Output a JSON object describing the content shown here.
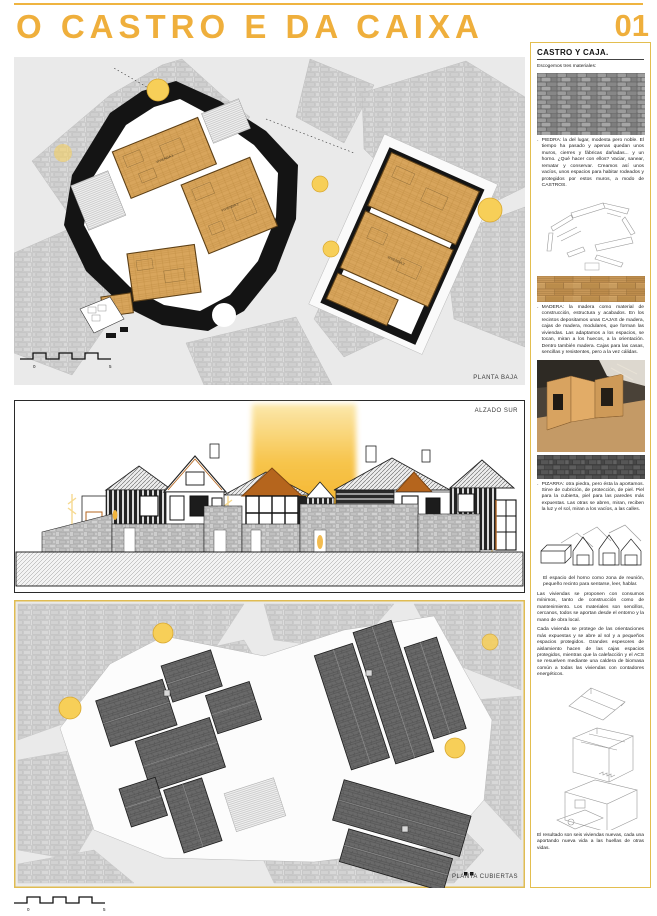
{
  "header": {
    "title": "O CASTRO E DA CAIXA",
    "page_number": "01"
  },
  "panels": {
    "planta_baja": {
      "label": "PLANTA BAJA",
      "scale_zero": "0",
      "scale_five": "5",
      "rooms": [
        "VIVIENDA 1",
        "VIVIENDA 2",
        "VIVIENDA 3"
      ]
    },
    "alzado_sur": {
      "label": "ALZADO SUR"
    },
    "planta_cubiertas": {
      "label": "PLANTA CUBIERTAS"
    },
    "page_scale": {
      "zero": "0",
      "five": "5"
    }
  },
  "sidebar": {
    "heading": "CASTRO Y CAJA.",
    "intro": "Escogemos tres materiales:",
    "bullet": "·",
    "piedra": "PIEDRA: la del lugar, modesta pero noble. El tiempo ha pasado y apenas quedan unos muros, cierres y fábricas dañadas... y un horno. ¿Qué hacer con ellos? Vaciar, sanear, rematar y conservar. Creamos así unos vacíos, unos espacios para habitar rodeados y protegidos por estos muros, a modo de CASTROS.",
    "madera": "MADERA: la madera como material de construcción, estructura y acabados. En los recintos depositamos unas CAJAS de madera, cajas de madera, modulares, que forman las viviendas. Las adaptamos a los espacios, se tocan, miran a los huecos, a la orientación. Dentro también madera. Cajas para las casas, sencillas y resistentes, pero a la vez cálidas.",
    "pizarra": "PIZARRA: otra piedra, pero ésta la aportamos. Sirve de cubrición, de protección, de piel. Piel para la cubierta, piel para las paredes más expuestas. Las otras se abren, miran, reciben la luz y el sol, miran a los vacíos, a las calles.",
    "horno": "El espacio del horno como zona de reunión, pequeño recinto para sentarse, leer, hablar.",
    "consumos": "Las viviendas se proponen con consumos mínimos, tanto de construcción como de mantenimiento. Los materiales son sencillos, cercanos, todos se aportan desde el entorno y la mano de obra local.",
    "proteccion": "Cada vivienda se protege de las orientaciones más expuestas y se abre al sol y a pequeños espacios protegidos. Grandes espesores de aislamiento hacen de las cajas espacios protegidos, mientras que la calefacción y el ACS se resuelven mediante una caldera de biomasa común a todas las viviendas con contadores energéticos.",
    "resultado": "El resultado son seis viviendas nuevas, cada una aportando nueva vida a las huellas de otras vidas."
  },
  "colors": {
    "accent_yellow": "#EFAF3C",
    "panel_border_yellow": "#E3BE4F",
    "wood_floor": "#D8A55C",
    "wall_black": "#141414",
    "slate_gray": "#696969",
    "sun_orange": "#F2A104"
  }
}
